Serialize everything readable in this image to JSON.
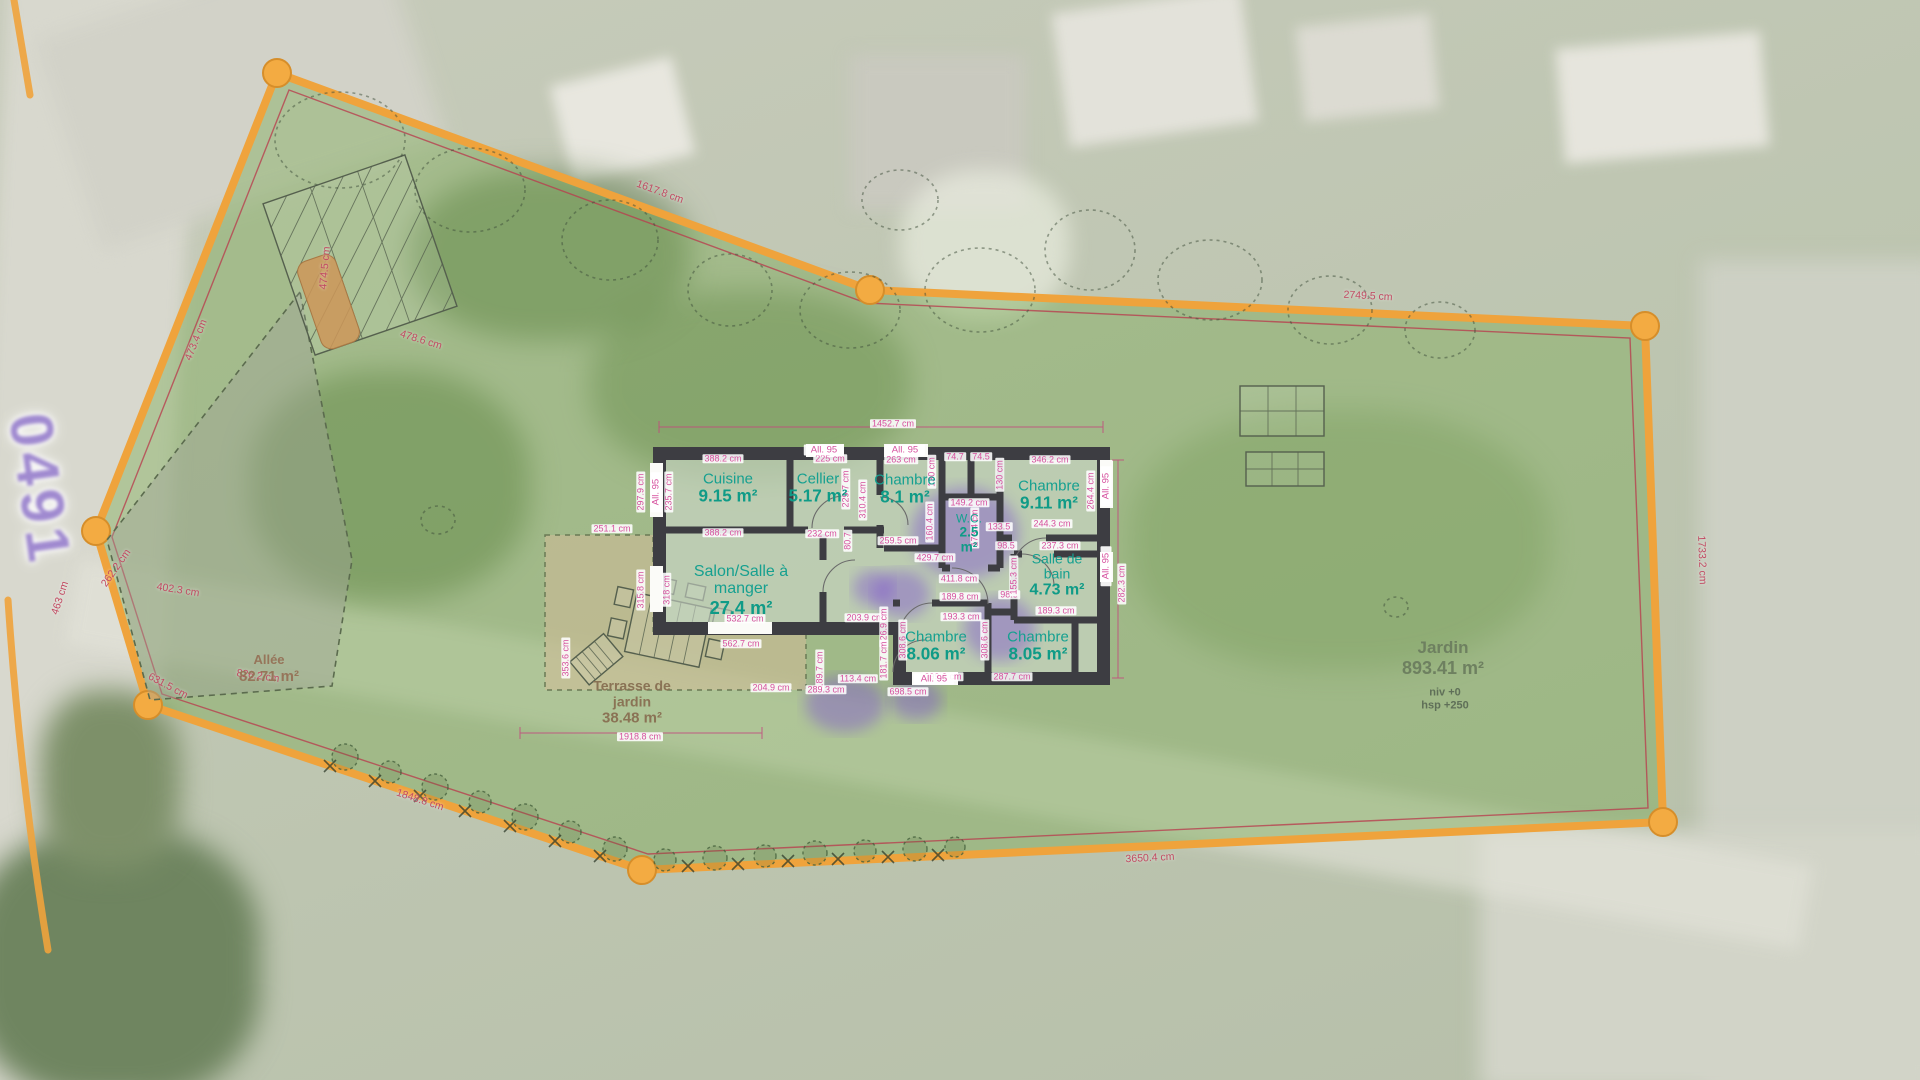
{
  "site": {
    "parcel_number": "0491",
    "garden": {
      "name": "Jardin",
      "area": "893.41 m²",
      "level": "niv +0",
      "height": "hsp +250"
    },
    "allee": {
      "name": "Allée",
      "area": "82.71 m²"
    },
    "terrace": {
      "name_lines": [
        "Terrasse de",
        "jardin"
      ],
      "area": "38.48 m²"
    }
  },
  "house": {
    "window_label": "All. 95",
    "rooms": [
      {
        "id": "cuisine",
        "name_lines": [
          "Cuisine"
        ],
        "area": "9.15 m²",
        "x": 728,
        "y": 489,
        "fs": 15
      },
      {
        "id": "cellier",
        "name_lines": [
          "Cellier"
        ],
        "area": "5.17 m²",
        "x": 818,
        "y": 489,
        "fs": 15
      },
      {
        "id": "chambre-1",
        "name_lines": [
          "Chambre"
        ],
        "area": "8.1 m²",
        "x": 905,
        "y": 490,
        "fs": 15
      },
      {
        "id": "chambre-2",
        "name_lines": [
          "Chambre"
        ],
        "area": "9.11 m²",
        "x": 1049,
        "y": 496,
        "fs": 15
      },
      {
        "id": "wc",
        "name_lines": [
          "W.C."
        ],
        "area": "2.5 m²",
        "x": 969,
        "y": 534,
        "fs": 12,
        "stack": true
      },
      {
        "id": "salle-de-bain",
        "name_lines": [
          "Salle de",
          "bain"
        ],
        "area": "4.73 m²",
        "x": 1057,
        "y": 575,
        "fs": 14
      },
      {
        "id": "salon",
        "name_lines": [
          "Salon/Salle à",
          "manger"
        ],
        "area": "27.4 m²",
        "x": 741,
        "y": 590,
        "fs": 16
      },
      {
        "id": "chambre-3",
        "name_lines": [
          "Chambre"
        ],
        "area": "8.06 m²",
        "x": 936,
        "y": 647,
        "fs": 15
      },
      {
        "id": "chambre-4",
        "name_lines": [
          "Chambre"
        ],
        "area": "8.05 m²",
        "x": 1038,
        "y": 647,
        "fs": 15
      }
    ],
    "dims": [
      {
        "t": "1452.7 cm",
        "x": 893,
        "y": 424
      },
      {
        "t": "388.2 cm",
        "x": 723,
        "y": 459
      },
      {
        "t": "225 cm",
        "x": 830,
        "y": 459
      },
      {
        "t": "263 cm",
        "x": 901,
        "y": 460
      },
      {
        "t": "74.7",
        "x": 955,
        "y": 457
      },
      {
        "t": "74.5",
        "x": 981,
        "y": 457
      },
      {
        "t": "346.2 cm",
        "x": 1050,
        "y": 460
      },
      {
        "t": "297.9 cm",
        "x": 641,
        "y": 492,
        "r": -90
      },
      {
        "t": "235.7 cm",
        "x": 669,
        "y": 492,
        "r": -90
      },
      {
        "t": "229.7 cm",
        "x": 846,
        "y": 489,
        "r": -90
      },
      {
        "t": "310.4 cm",
        "x": 863,
        "y": 500,
        "r": -90
      },
      {
        "t": "130 cm",
        "x": 932,
        "y": 472,
        "r": -90
      },
      {
        "t": "130 cm",
        "x": 1000,
        "y": 475,
        "r": -90
      },
      {
        "t": "149.2 cm",
        "x": 969,
        "y": 503
      },
      {
        "t": "160.4 cm",
        "x": 930,
        "y": 522,
        "r": -90
      },
      {
        "t": "173.4 cm",
        "x": 975,
        "y": 528,
        "r": -90
      },
      {
        "t": "264.4 cm",
        "x": 1091,
        "y": 491,
        "r": -90
      },
      {
        "t": "251.1 cm",
        "x": 612,
        "y": 529
      },
      {
        "t": "388.2 cm",
        "x": 723,
        "y": 533
      },
      {
        "t": "232 cm",
        "x": 822,
        "y": 534
      },
      {
        "t": "80.7",
        "x": 848,
        "y": 541,
        "r": -90
      },
      {
        "t": "259.5 cm",
        "x": 898,
        "y": 541
      },
      {
        "t": "429.7 cm",
        "x": 935,
        "y": 558
      },
      {
        "t": "244.3 cm",
        "x": 1052,
        "y": 524
      },
      {
        "t": "237.3 cm",
        "x": 1060,
        "y": 546
      },
      {
        "t": "133.5",
        "x": 999,
        "y": 527
      },
      {
        "t": "98.5",
        "x": 1006,
        "y": 546
      },
      {
        "t": "98.5",
        "x": 1009,
        "y": 595
      },
      {
        "t": "155.3 cm",
        "x": 1014,
        "y": 576,
        "r": -90
      },
      {
        "t": "411.8 cm",
        "x": 959,
        "y": 579
      },
      {
        "t": "189.8 cm",
        "x": 960,
        "y": 597
      },
      {
        "t": "193.3 cm",
        "x": 961,
        "y": 617
      },
      {
        "t": "189.3 cm",
        "x": 1056,
        "y": 611
      },
      {
        "t": "308.6 cm",
        "x": 903,
        "y": 640,
        "r": -90
      },
      {
        "t": "308.6 cm",
        "x": 985,
        "y": 640,
        "r": -90
      },
      {
        "t": "287.7 cm",
        "x": 1012,
        "y": 677
      },
      {
        "t": "299.3 cm",
        "x": 943,
        "y": 677
      },
      {
        "t": "203.9 cm",
        "x": 865,
        "y": 618
      },
      {
        "t": "532.7 cm",
        "x": 745,
        "y": 619
      },
      {
        "t": "562.7 cm",
        "x": 741,
        "y": 644
      },
      {
        "t": "126.9 cm",
        "x": 884,
        "y": 627,
        "r": -90
      },
      {
        "t": "181.7 cm",
        "x": 884,
        "y": 660,
        "r": -90
      },
      {
        "t": "189.7 cm",
        "x": 820,
        "y": 670,
        "r": -90
      },
      {
        "t": "113.4 cm",
        "x": 858,
        "y": 679
      },
      {
        "t": "204.9 cm",
        "x": 771,
        "y": 688
      },
      {
        "t": "289.3 cm",
        "x": 826,
        "y": 690
      },
      {
        "t": "698.5 cm",
        "x": 908,
        "y": 692
      },
      {
        "t": "315.8 cm",
        "x": 641,
        "y": 590,
        "r": -90
      },
      {
        "t": "318 cm",
        "x": 667,
        "y": 590,
        "r": -90
      },
      {
        "t": "282.3 cm",
        "x": 1122,
        "y": 584,
        "r": -90
      },
      {
        "t": "353.6 cm",
        "x": 566,
        "y": 658,
        "r": -90
      },
      {
        "t": "1918.8 cm",
        "x": 640,
        "y": 737
      }
    ],
    "window_chips": [
      {
        "x": 824,
        "y": 450
      },
      {
        "x": 905,
        "y": 450
      },
      {
        "x": 656,
        "y": 492,
        "r": -90
      },
      {
        "x": 1106,
        "y": 486,
        "r": -90
      },
      {
        "x": 1106,
        "y": 566,
        "r": -90
      },
      {
        "x": 934,
        "y": 679
      }
    ]
  },
  "boundary": {
    "dims": [
      {
        "t": "1617.8 cm",
        "x": 660,
        "y": 192,
        "r": 20
      },
      {
        "t": "2749.5 cm",
        "x": 1368,
        "y": 296,
        "r": 3
      },
      {
        "t": "1733.2 cm",
        "x": 1702,
        "y": 560,
        "r": 88
      },
      {
        "t": "3650.4 cm",
        "x": 1150,
        "y": 858,
        "r": -3
      },
      {
        "t": "1848.8 cm",
        "x": 420,
        "y": 800,
        "r": 18
      },
      {
        "t": "631.5 cm",
        "x": 168,
        "y": 686,
        "r": 28
      },
      {
        "t": "826.2 cm",
        "x": 258,
        "y": 676,
        "r": 8
      },
      {
        "t": "402.3 cm",
        "x": 178,
        "y": 590,
        "r": 9
      },
      {
        "t": "473.4 cm",
        "x": 196,
        "y": 340,
        "r": -68
      },
      {
        "t": "474.5 cm",
        "x": 325,
        "y": 268,
        "r": -85
      },
      {
        "t": "478.6 cm",
        "x": 421,
        "y": 340,
        "r": 17
      },
      {
        "t": "262.2 cm",
        "x": 116,
        "y": 568,
        "r": -55
      },
      {
        "t": "463 cm",
        "x": 60,
        "y": 598,
        "r": -72
      }
    ]
  }
}
